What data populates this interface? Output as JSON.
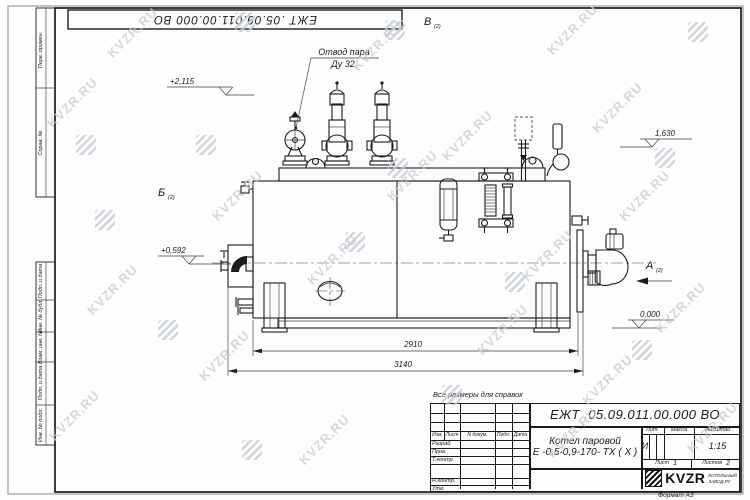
{
  "watermark": {
    "text": "KVZR.RU"
  },
  "frame": {
    "top_doc_number": "ЕЖТ .05.09.011.00.000  ВО",
    "side_top": [
      "Перв. примен.",
      "Справ. №"
    ],
    "side_bottom": [
      "Подп. и дата",
      "Инв. № дубл.",
      "Взам. инв. №",
      "Подп. и дата",
      "Инв. № подл."
    ],
    "format_note": "Формат А3"
  },
  "drawing": {
    "callout_line1": "Отвод пара",
    "callout_line2": "Ду 32",
    "view_b": "В",
    "view_b_sub": "(2)",
    "section_b": "Б",
    "section_b_sub": "(2)",
    "view_a": "А",
    "view_a_sub": "(2)",
    "elev_2115": "+2,115",
    "elev_1630": "1,630",
    "elev_0592": "+0,592",
    "elev_0000": "0,000",
    "dim_2910": "2910",
    "dim_3140": "3140"
  },
  "title_block": {
    "note": "Все размеры для справок",
    "doc_number": "ЕЖТ .05.09.011.00.000  ВО",
    "name_line1": "Котел паровой",
    "name_line2": "Е -0,5-0,9-170- ТХ ( Х )",
    "col_izm": "Изм.",
    "col_list": "Лист",
    "col_ndoc": "N докум.",
    "col_podp": "Подп.",
    "col_data": "Дата",
    "row_razrab": "Разраб.",
    "row_prov": "Пров.",
    "row_tkontr": "Т.контр.",
    "row_nkontr": "Н.контр.",
    "row_utv": "Утв.",
    "lit_label": "Лит.",
    "mass_label": "Масса",
    "scale_label": "Масштаб",
    "lit_value": "И",
    "scale_value": "1:15",
    "sheet_label": "Лист",
    "sheet_num": "1",
    "sheets_label": "Листов",
    "sheets_num": "2",
    "brand": "KVZR",
    "brand_sub1": "КОТЕЛЬНЫЙ",
    "brand_sub2": "ЗАВОД.РУ"
  }
}
